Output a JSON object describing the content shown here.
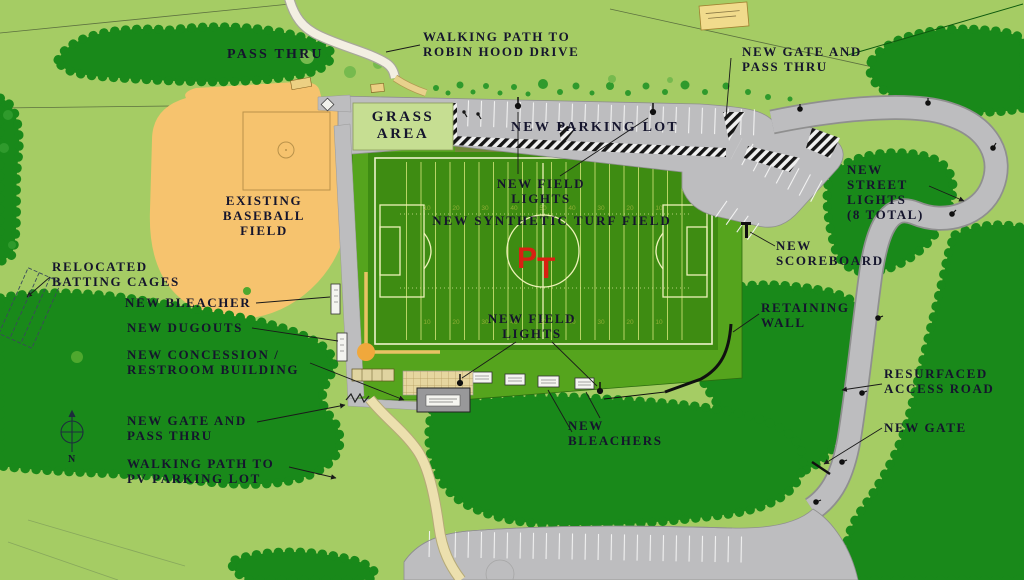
{
  "map": {
    "region_labels": {
      "pass_thru": "PASS THRU",
      "grass_area_1": "GRASS",
      "grass_area_2": "AREA",
      "new_parking_lot": "NEW PARKING LOT",
      "existing_baseball_1": "EXISTING",
      "existing_baseball_2": "BASEBALL",
      "existing_baseball_3": "FIELD",
      "new_synthetic_turf_field": "NEW SYNTHETIC TURF FIELD",
      "monogram_p": "P",
      "monogram_t": "T"
    },
    "callouts": {
      "walking_path_robin_hood_1": "WALKING PATH TO",
      "walking_path_robin_hood_2": "ROBIN HOOD DRIVE",
      "new_gate_pass_thru_top_1": "NEW GATE AND",
      "new_gate_pass_thru_top_2": "PASS THRU",
      "new_field_lights_top_1": "NEW FIELD",
      "new_field_lights_top_2": "LIGHTS",
      "new_field_lights_bottom_1": "NEW FIELD",
      "new_field_lights_bottom_2": "LIGHTS",
      "new_street_lights_1": "NEW",
      "new_street_lights_2": "STREET",
      "new_street_lights_3": "LIGHTS",
      "new_street_lights_4": "(8 TOTAL)",
      "new_scoreboard_1": "NEW",
      "new_scoreboard_2": "SCOREBOARD",
      "retaining_wall_1": "RETAINING",
      "retaining_wall_2": "WALL",
      "resurfaced_access_road_1": "RESURFACED",
      "resurfaced_access_road_2": "ACCESS ROAD",
      "new_gate_right": "NEW GATE",
      "new_bleachers_1": "NEW",
      "new_bleachers_2": "BLEACHERS",
      "relocated_batting_cages_1": "RELOCATED",
      "relocated_batting_cages_2": "BATTING CAGES",
      "new_bleacher": "NEW BLEACHER",
      "new_dugouts": "NEW DUGOUTS",
      "new_concession_1": "NEW CONCESSION /",
      "new_concession_2": "RESTROOM BUILDING",
      "new_gate_pass_thru_left_1": "NEW GATE AND",
      "new_gate_pass_thru_left_2": "PASS THRU",
      "walking_path_pv_1": "WALKING PATH TO",
      "walking_path_pv_2": "PV PARKING LOT"
    },
    "compass": {
      "north": "N"
    },
    "field": {
      "yard_numbers": [
        "10",
        "20",
        "30",
        "40",
        "50",
        "40",
        "30",
        "20",
        "10"
      ]
    },
    "colors": {
      "background_green": "#a5cc64",
      "tree_green": "#19891a",
      "turf_green": "#3e8c12",
      "apron_green": "#55a41d",
      "baseball_tan": "#f6c36e",
      "road_gray": "#bdbdbf",
      "path_cream": "#ece0ae",
      "monogram_red": "#d92012",
      "label_ink": "#15152d",
      "note_yellow": "#f1db8c"
    }
  }
}
